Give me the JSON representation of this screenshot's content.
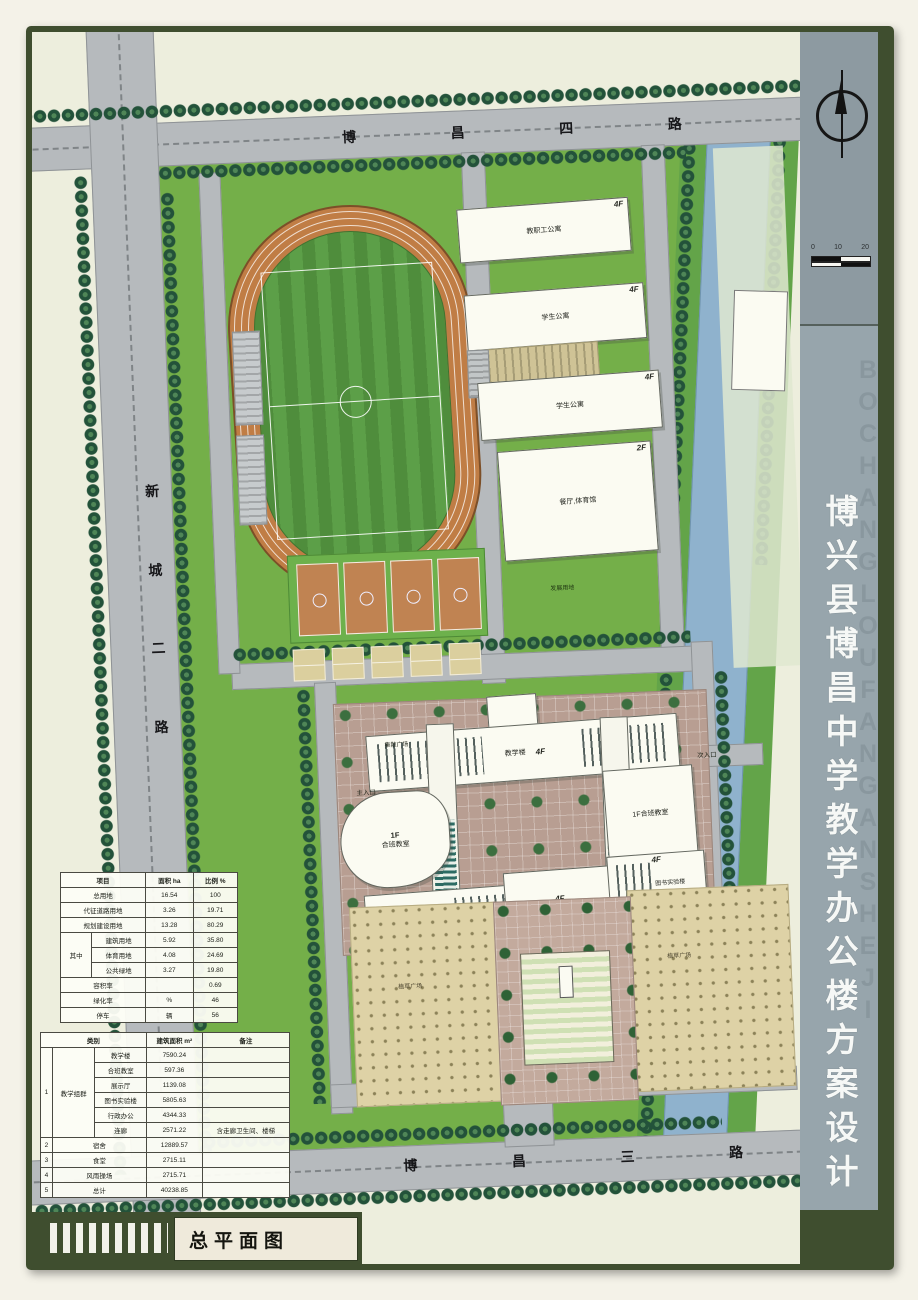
{
  "sheet": {
    "drawing_title": "总平面图",
    "project_title_vertical": "博兴县博昌中学教学办公楼方案设计",
    "watermark_text": "BOCHANGLOUFANGANSHEJI"
  },
  "compass": {
    "ticks": [
      "0",
      "10",
      "20"
    ]
  },
  "roads": {
    "north": {
      "chars": [
        "博",
        "昌",
        "四",
        "路"
      ]
    },
    "west": {
      "chars": [
        "新",
        "城",
        "二",
        "路"
      ]
    },
    "south": {
      "chars": [
        "博",
        "昌",
        "三",
        "路"
      ]
    }
  },
  "labels": {
    "development_land": "发展用地",
    "gathering_plaza": "集散广场",
    "main_entrance": "主入口",
    "secondary_entrance": "次入口",
    "plaza_left": "植草广场",
    "plaza_right": "植草广场"
  },
  "buildings": {
    "staff_apartment": {
      "name": "教职工公寓",
      "floors": "4F"
    },
    "student_apartment_1": {
      "name": "学生公寓",
      "floors": "4F"
    },
    "student_apartment_2": {
      "name": "学生公寓",
      "floors": "4F"
    },
    "dining_gym": {
      "name": "餐厅,体育馆",
      "floors": "2F"
    },
    "teaching": {
      "name": "教学楼",
      "floors": "4F"
    },
    "west_classroom": {
      "name": "合班教室",
      "floors": "1F"
    },
    "east_classroom": {
      "name": "1F合班教室"
    },
    "admin": {
      "name": "展示厅,行政办公楼",
      "floors": "4F"
    },
    "library_lab": {
      "name": "图书实验楼",
      "floors": "4F"
    },
    "south_center": {
      "floors": "4F"
    }
  },
  "land_use_table": {
    "header": [
      {
        "t": "项目",
        "cs": 2
      },
      {
        "t": "面积 ha"
      },
      {
        "t": "比例 %"
      }
    ],
    "rows": [
      [
        {
          "t": "总用地",
          "cs": 2
        },
        {
          "t": "16.54"
        },
        {
          "t": "100"
        }
      ],
      [
        {
          "t": "代征道路用地",
          "cs": 2
        },
        {
          "t": "3.26"
        },
        {
          "t": "19.71"
        }
      ],
      [
        {
          "t": "规划建设用地",
          "cs": 2
        },
        {
          "t": "13.28"
        },
        {
          "t": "80.29"
        }
      ],
      [
        {
          "t": "其中",
          "rs": 3
        },
        {
          "t": "建筑用地"
        },
        {
          "t": "5.92"
        },
        {
          "t": "35.80"
        }
      ],
      [
        {
          "t": "体育用地"
        },
        {
          "t": "4.08"
        },
        {
          "t": "24.69"
        }
      ],
      [
        {
          "t": "公共绿地"
        },
        {
          "t": "3.27"
        },
        {
          "t": "19.80"
        }
      ],
      [
        {
          "t": "容积率",
          "cs": 2
        },
        {
          "t": ""
        },
        {
          "t": "0.69"
        }
      ],
      [
        {
          "t": "绿化率",
          "cs": 2
        },
        {
          "t": "%"
        },
        {
          "t": "46"
        }
      ],
      [
        {
          "t": "停车",
          "cs": 2
        },
        {
          "t": "辆"
        },
        {
          "t": "56"
        }
      ]
    ]
  },
  "area_table": {
    "header": [
      {
        "t": "类别",
        "cs": 3
      },
      {
        "t": "建筑面积 m²"
      },
      {
        "t": "备注"
      }
    ],
    "rows": [
      [
        {
          "t": "1",
          "rs": 6
        },
        {
          "t": "教学组群",
          "rs": 6
        },
        {
          "t": "教学楼"
        },
        {
          "t": "7590.24"
        },
        {
          "t": ""
        }
      ],
      [
        {
          "t": "合班教室"
        },
        {
          "t": "597.36"
        },
        {
          "t": ""
        }
      ],
      [
        {
          "t": "展示厅"
        },
        {
          "t": "1139.08"
        },
        {
          "t": ""
        }
      ],
      [
        {
          "t": "图书实验楼"
        },
        {
          "t": "5805.63"
        },
        {
          "t": ""
        }
      ],
      [
        {
          "t": "行政办公"
        },
        {
          "t": "4344.33"
        },
        {
          "t": ""
        }
      ],
      [
        {
          "t": "连廊"
        },
        {
          "t": "2571.22"
        },
        {
          "t": "含走廊卫生间、楼梯"
        }
      ],
      [
        {
          "t": "2"
        },
        {
          "t": "宿舍",
          "cs": 2
        },
        {
          "t": "12889.57"
        },
        {
          "t": ""
        }
      ],
      [
        {
          "t": "3"
        },
        {
          "t": "食堂",
          "cs": 2
        },
        {
          "t": "2715.11"
        },
        {
          "t": ""
        }
      ],
      [
        {
          "t": "4"
        },
        {
          "t": "风雨操场",
          "cs": 2
        },
        {
          "t": "2715.71"
        },
        {
          "t": ""
        }
      ],
      [
        {
          "t": "5"
        },
        {
          "t": "总计",
          "cs": 2
        },
        {
          "t": "40238.85"
        },
        {
          "t": ""
        }
      ]
    ]
  },
  "colors": {
    "frame_green": "#3f4e2f",
    "sidebar_gray": "#97a5ac",
    "campus_green": "#74af49",
    "track_orange": "#c07d45",
    "river_blue": "#8fb2cd",
    "paper": "#edeedd"
  }
}
